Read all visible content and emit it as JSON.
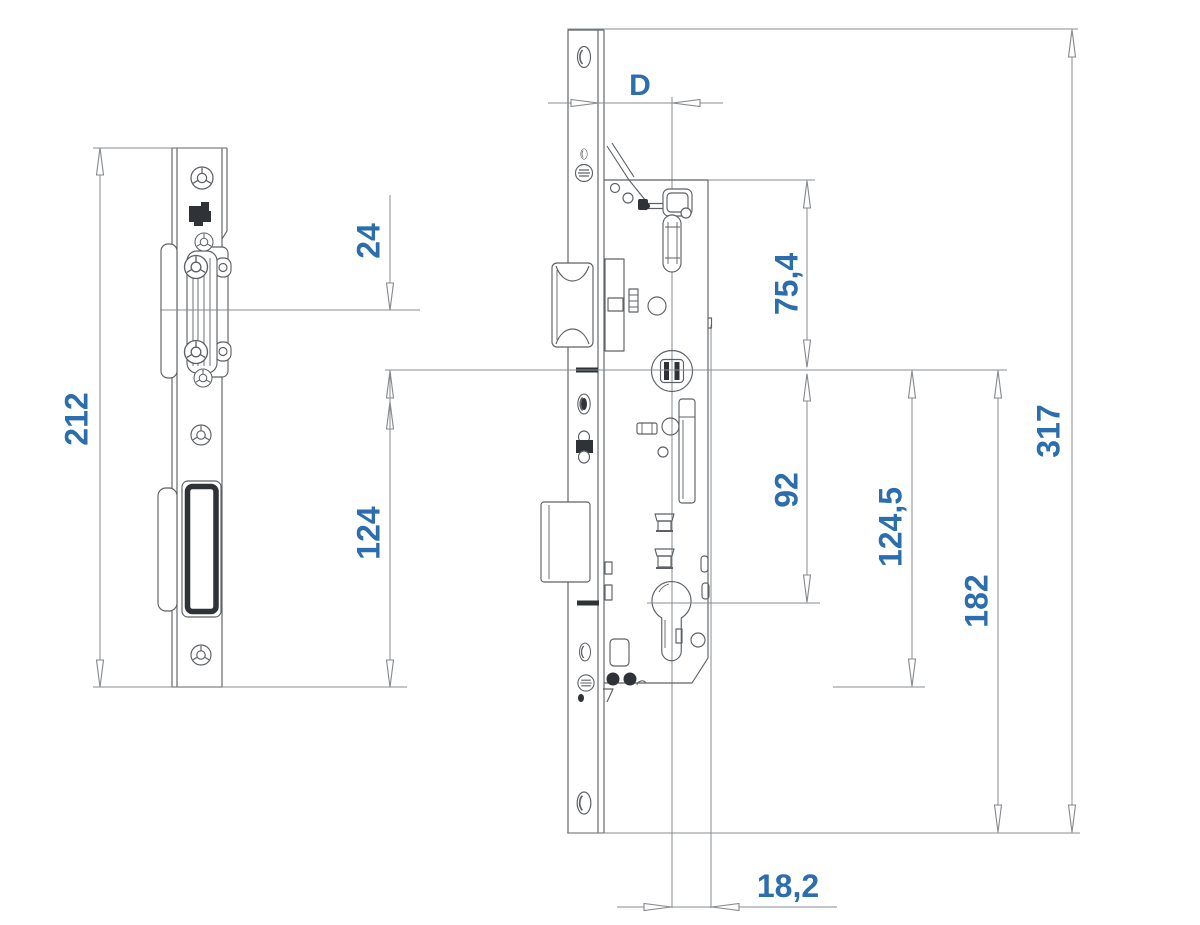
{
  "dimensions": {
    "keep_height": "212",
    "roller_to_axis": "24",
    "axis_to_keep_bottom": "124",
    "backset": "D",
    "case_top_to_axis": "75,4",
    "axis_to_cylinder": "92",
    "axis_to_ref": "124,5",
    "axis_to_plate_bottom": "182",
    "plate_height": "317",
    "cylinder_to_edge": "18,2"
  },
  "colors": {
    "dimension_text": "#2b6dad",
    "drawing_line": "#5d6165",
    "dimension_line": "#878c90",
    "dark_fill": "#2f3236",
    "background": "#ffffff"
  }
}
